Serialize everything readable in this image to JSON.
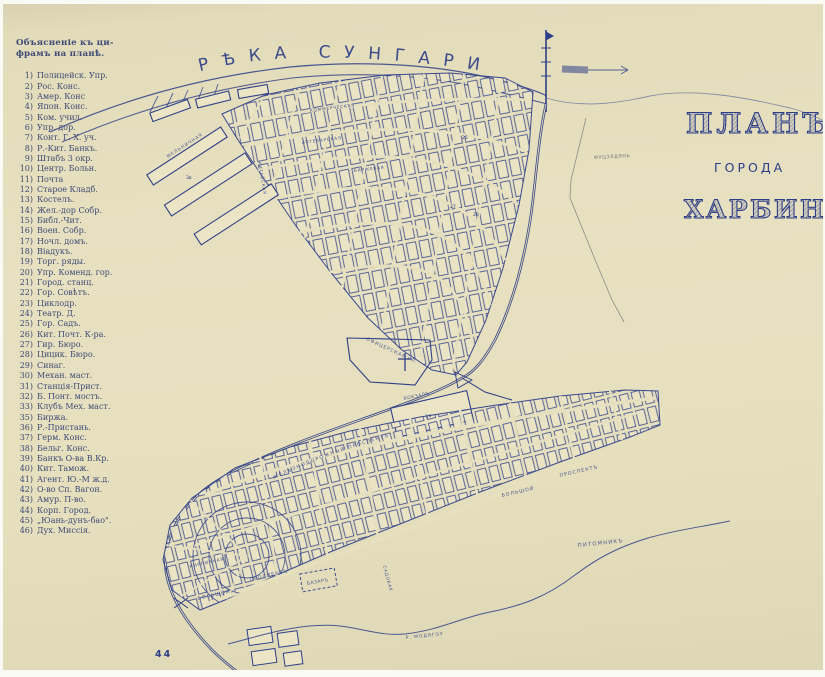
{
  "page_number": "44",
  "legend": {
    "title_line1": "Объясненіе къ ци-",
    "title_line2": "фрамъ на планѣ.",
    "items": [
      {
        "n": "1)",
        "t": "Полицейск. Упр."
      },
      {
        "n": "2)",
        "t": "Рос. Конс."
      },
      {
        "n": "3)",
        "t": "Амер. Конс"
      },
      {
        "n": "4)",
        "t": "Япон. Конс."
      },
      {
        "n": "5)",
        "t": "Ком. учил."
      },
      {
        "n": "6)",
        "t": "Упр. дор."
      },
      {
        "n": "7)",
        "t": "Конт. Г. Х. уч."
      },
      {
        "n": "8)",
        "t": "Р.-Кит. Банкъ."
      },
      {
        "n": "9)",
        "t": "Штабъ 3 окр."
      },
      {
        "n": "10)",
        "t": "Центр. Больн."
      },
      {
        "n": "11)",
        "t": "Почта"
      },
      {
        "n": "12)",
        "t": "Старое Кладб."
      },
      {
        "n": "13)",
        "t": "Костелъ."
      },
      {
        "n": "14)",
        "t": "Жел.-дор Собр."
      },
      {
        "n": "15)",
        "t": "Библ.-Чит."
      },
      {
        "n": "16)",
        "t": "Воен. Собр."
      },
      {
        "n": "17)",
        "t": "Ночл. домъ."
      },
      {
        "n": "18)",
        "t": "Віадукъ."
      },
      {
        "n": "19)",
        "t": "Торг. ряды."
      },
      {
        "n": "20)",
        "t": "Упр. Коменд. гор."
      },
      {
        "n": "21)",
        "t": "Город. станц."
      },
      {
        "n": "22)",
        "t": "Гор. Совѣтъ."
      },
      {
        "n": "23)",
        "t": "Циклодр."
      },
      {
        "n": "24)",
        "t": "Театр. Д."
      },
      {
        "n": "25)",
        "t": "Гор. Садъ."
      },
      {
        "n": "26)",
        "t": "Кит. Почт. К-ра."
      },
      {
        "n": "27)",
        "t": "Гир. Бюро."
      },
      {
        "n": "28)",
        "t": "Цицик. Бюро."
      },
      {
        "n": "29)",
        "t": "Синаг."
      },
      {
        "n": "30)",
        "t": "Механ. маст."
      },
      {
        "n": "31)",
        "t": "Станція-Прист."
      },
      {
        "n": "32)",
        "t": "Б. Понт. мостъ."
      },
      {
        "n": "33)",
        "t": "Клубъ Мех. маст."
      },
      {
        "n": "35)",
        "t": "Биржа."
      },
      {
        "n": "36)",
        "t": "Р.-Пристань."
      },
      {
        "n": "37)",
        "t": "Герм. Конс."
      },
      {
        "n": "38)",
        "t": "Бельг. Конс."
      },
      {
        "n": "39)",
        "t": "Банкъ О-ва В.Кр."
      },
      {
        "n": "40)",
        "t": "Кит. Тамож."
      },
      {
        "n": "41)",
        "t": "Агент. Ю.-М ж.д."
      },
      {
        "n": "42)",
        "t": "О-во Сп. Вагон."
      },
      {
        "n": "43)",
        "t": "Амур. П-во."
      },
      {
        "n": "44)",
        "t": "Корп. Город."
      },
      {
        "n": "45)",
        "t": "„Юань-дунъ-бао\"."
      },
      {
        "n": "46)",
        "t": "Дух. Миссія."
      }
    ]
  },
  "title": {
    "line1": "ПЛАНЪ",
    "line2": "ГОРОДА",
    "line3": "ХАРБИНА"
  },
  "river_label": "РѢКА  СУНГАРИ",
  "map_labels": {
    "melnichnaya": "МЕЛЬНИЧНАЯ",
    "kitayskaya": "КИТАЙСКАЯ",
    "kommercheskaya": "КОММЕРЧЕСКАЯ",
    "aptekarskaya": "АПТЕКАРСКАЯ",
    "birzhevaya": "БИРЖЕВАЯ",
    "ofitserskaya": "ОФИЦЕРСКАЯ УЛ.",
    "vokzal": "ВОКЗАЛЪ",
    "zhd_prospekt": "ЖЕЛѢЗНОДОРОЖНЫЙ ПРОСПЕКТЪ",
    "bolshoy_w": "БОЛЬШОЙ",
    "prospekt_w": "ПРОСПЕКТЪ",
    "bolshoy_e": "БОЛЬШОЙ",
    "prospekt_e": "ПРОСПЕКТЪ",
    "kirpichnaya": "КИРПИЧНАЯ",
    "sadovaya": "САДОВАЯ",
    "bazar": "БАЗАРЪ",
    "pitomnik": "ПИТОМНИКЪ",
    "modyagou": "Р. МОДЯГОУ",
    "fudziadian": "ФУЦЗЯДЯНЬ"
  },
  "map_numbers": {
    "b3": "3в",
    "n25": "25",
    "n27": "27",
    "n28": "28",
    "n1v": "1в"
  }
}
